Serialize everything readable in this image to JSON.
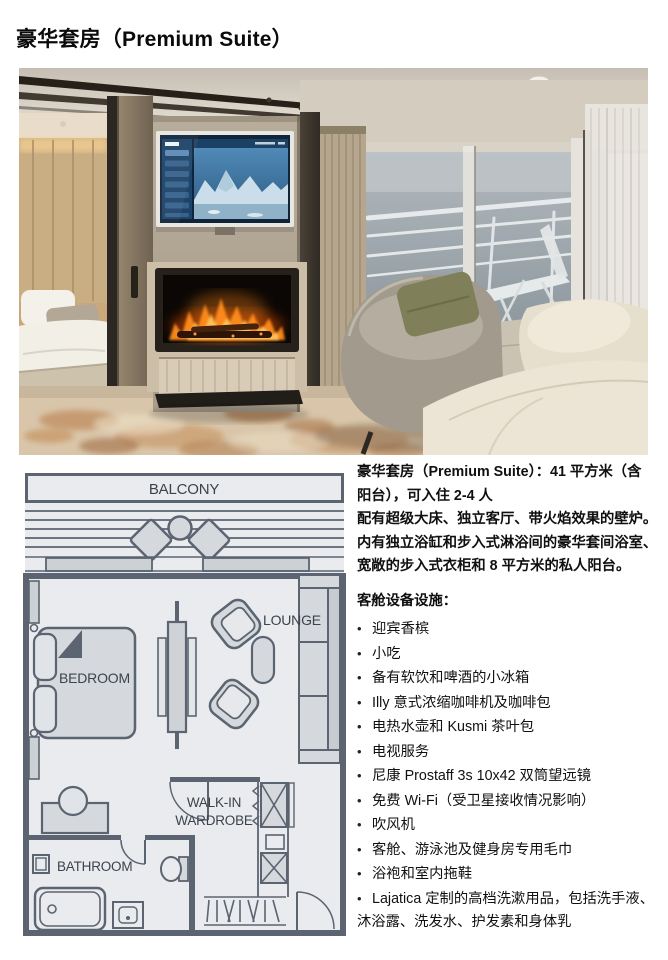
{
  "page": {
    "title": "豪华套房（Premium Suite）",
    "background": "#ffffff",
    "text_color": "#101010"
  },
  "description": {
    "lines": [
      "豪华套房（Premium Suite）：41 平方米（含",
      "阳台），可入住 2-4 人",
      "配有超级大床、独立客厅、带火焰效果的壁炉。",
      "内有独立浴缸和步入式淋浴间的豪华套间浴室、",
      "宽敞的步入式衣柜和 8 平方米的私人阳台。"
    ]
  },
  "amenities": {
    "heading": "客舱设备设施：",
    "bullet_char": "•",
    "items": [
      "迎宾香槟",
      "小吃",
      "备有软饮和啤酒的小冰箱",
      "Illy 意式浓缩咖啡机及咖啡包",
      "电热水壶和 Kusmi 茶叶包",
      "电视服务",
      "尼康 Prostaff 3s 10x42 双筒望远镜",
      "免费 Wi-Fi（受卫星接收情况影响）",
      "吹风机",
      "客舱、游泳池及健身房专用毛巾",
      "浴袍和室内拖鞋",
      "Lajatica 定制的高档洗漱用品，包括洗手液、沐浴露、洗发水、护发素和身体乳"
    ]
  },
  "floorplan": {
    "labels": {
      "balcony": "BALCONY",
      "bedroom": "BEDROOM",
      "lounge": "LOUNGE",
      "walkin_line1": "WALK-IN",
      "walkin_line2": "WARDROBE",
      "bathroom": "BATHROOM"
    },
    "colors": {
      "wall": "#5b6470",
      "room_fill": "#e9ebee",
      "furniture_fill": "#d5d9de",
      "label_text": "#3d434c"
    }
  },
  "photo": {
    "colors": {
      "flame": "#ff8c1f",
      "tv_screen_blue": "#3a79ad",
      "carpet_base": "#d9c6aa",
      "carpet_accent": "#b4713a",
      "sea": "#8b989e",
      "curtain": "#b5a68d",
      "sofa_cream": "#ece5d6"
    }
  }
}
